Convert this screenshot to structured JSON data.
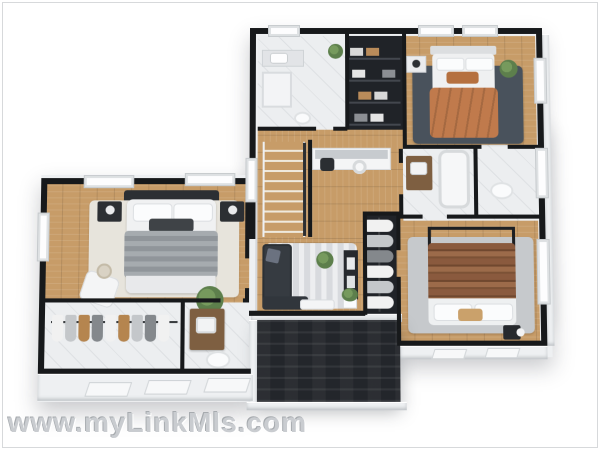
{
  "watermark": {
    "text": "www.myLinkMls.com"
  },
  "scene": {
    "type": "3d-floor-plan-render",
    "floor_shown": "upper floor with 3 bedrooms, 3 baths, walk-in closets, stairs, den and porch roof"
  },
  "palette": {
    "frame_border": "#d7d9db",
    "wall": "#17191b",
    "cap": "#eef0f2",
    "cap_edge": "#d8dbde",
    "wood": "#c79c68",
    "tile": "#eceef0",
    "dark_room": "#202328",
    "rug_cream": "#e7e4dc",
    "rug_dark": "#49525c",
    "rug_light": "#c6c9cc",
    "rug_den": "#d8dade",
    "sofa": "#363b41",
    "console": "#26292e",
    "bed_orange": "#c07a4c",
    "bed_gray": "#a6abaf",
    "bed_gray_dark": "#90959a",
    "bed_brown": "#8a5a3e",
    "white_furn": "#f4f5f6",
    "dark_furn": "#2c2f33",
    "wood_furn": "#7e5f41",
    "plant": "#5d7f4c",
    "roof": "#23262b",
    "watermark": "#c9ccd0",
    "cloth_white": "#f1f1f1",
    "cloth_gray": "#c4c7ca",
    "cloth_tan": "#b5854f",
    "cloth_dark": "#84888c"
  }
}
